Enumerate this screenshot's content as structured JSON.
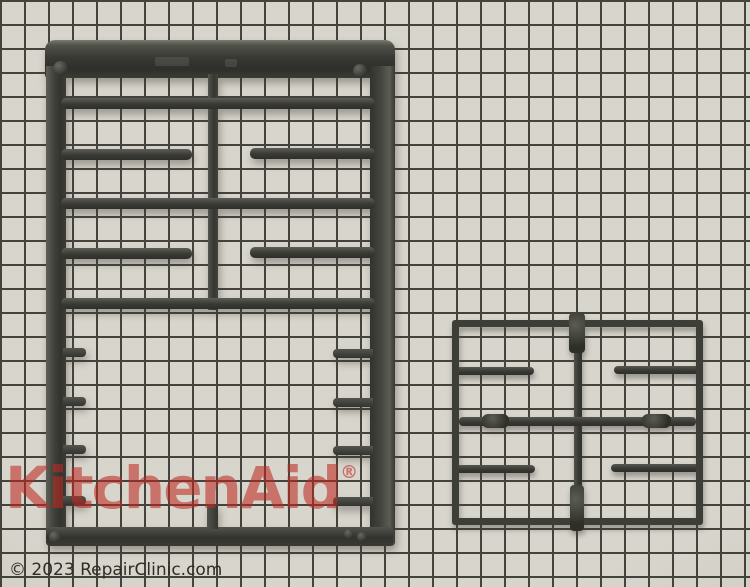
{
  "scene": {
    "background": {
      "cell_color": "#d6d3ca",
      "line_color": "#3d3b36",
      "cell_size_px": 24
    },
    "items": [
      {
        "name": "large-burner-grate",
        "color": "#31322c"
      },
      {
        "name": "small-burner-grate",
        "color": "#35362f"
      }
    ]
  },
  "watermark": {
    "brand": "KitchenAid",
    "registered_mark": "®",
    "color": "#ba201a"
  },
  "footer": {
    "copyright": "© 2023 RepairClinic.com"
  }
}
